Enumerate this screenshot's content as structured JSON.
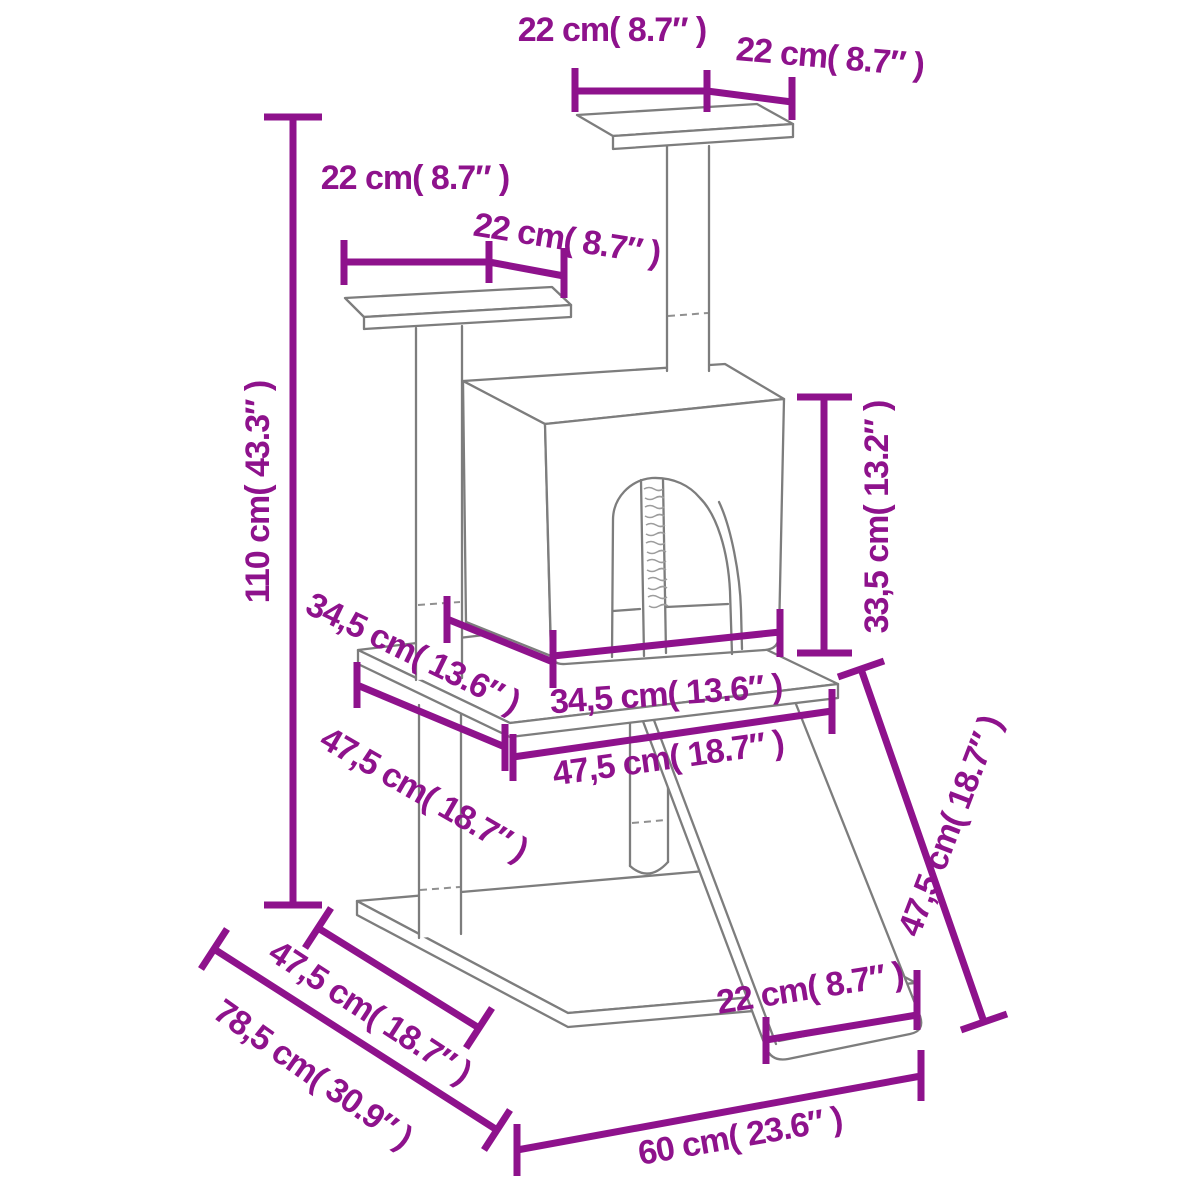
{
  "diagram": {
    "type": "product-dimension-diagram",
    "subject": "cat tree with scratching posts, condo, platforms and ramp",
    "background_color": "#ffffff",
    "dimension_color": "#8e128c",
    "outline_color": "#7d7d7d",
    "units": {
      "primary": "cm",
      "secondary": "inches"
    },
    "dimensions": [
      {
        "name": "top-platform-length",
        "text": "22 cm( 8.7″ )"
      },
      {
        "name": "top-platform-depth",
        "text": "22 cm( 8.7″ )"
      },
      {
        "name": "side-platform-length",
        "text": "22 cm( 8.7″ )"
      },
      {
        "name": "side-platform-depth",
        "text": "22 cm( 8.7″ )"
      },
      {
        "name": "total-height",
        "text": "110 cm( 43.3″ )"
      },
      {
        "name": "condo-height",
        "text": "33,5 cm( 13.2″ )"
      },
      {
        "name": "condo-depth",
        "text": "34,5 cm( 13.6″ )"
      },
      {
        "name": "condo-width",
        "text": "34,5 cm( 13.6″ )"
      },
      {
        "name": "middle-board-depth",
        "text": "47,5 cm( 18.7″ )"
      },
      {
        "name": "middle-board-width",
        "text": "47,5 cm( 18.7″ )"
      },
      {
        "name": "ramp-length",
        "text": "47,5 cm( 18.7″ )"
      },
      {
        "name": "ramp-width",
        "text": "22 cm( 8.7″ )"
      },
      {
        "name": "base-depth",
        "text": "47,5 cm( 18.7″ )"
      },
      {
        "name": "footprint-depth",
        "text": "78,5 cm( 30.9″ )"
      },
      {
        "name": "base-width",
        "text": "60 cm( 23.6″ )"
      }
    ]
  }
}
